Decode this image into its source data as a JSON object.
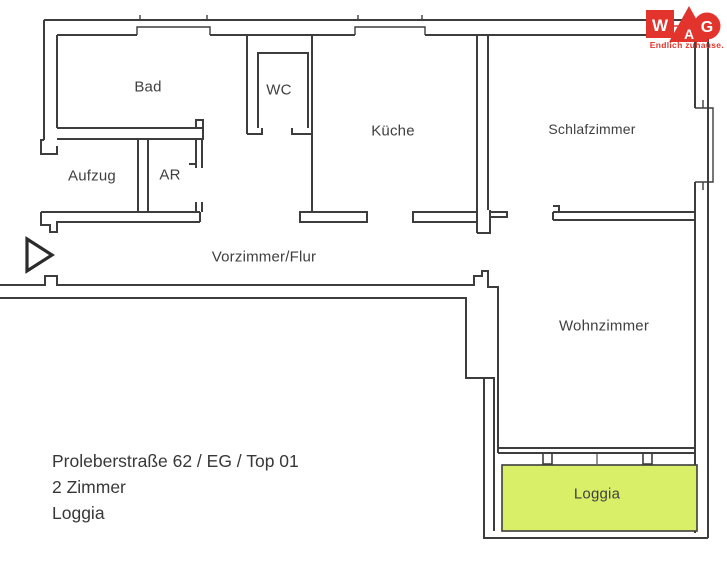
{
  "rooms": {
    "bad": "Bad",
    "wc": "WC",
    "kueche": "Küche",
    "schlafzimmer": "Schlafzimmer",
    "aufzug": "Aufzug",
    "ar": "AR",
    "vorzimmer": "Vorzimmer/Flur",
    "wohnzimmer": "Wohnzimmer",
    "loggia": "Loggia"
  },
  "address": {
    "line1": "Proleberstraße 62 / EG / Top 01",
    "line2": "2 Zimmer",
    "line3": "Loggia"
  },
  "logo": {
    "letter_w": "W",
    "letter_a": "A",
    "letter_g": "G",
    "tagline": "Endlich zuhause.",
    "brand_color": "#e2342c"
  },
  "colors": {
    "wall": "#3d3d3d",
    "loggia_fill": "#d9ef67",
    "background": "#ffffff"
  }
}
